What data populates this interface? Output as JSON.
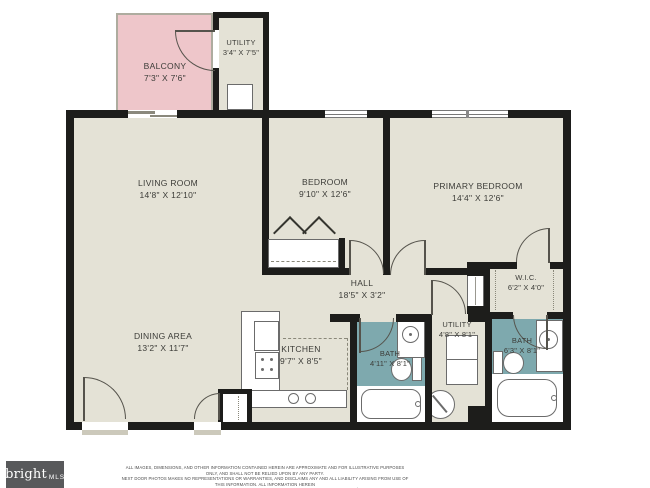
{
  "rooms": {
    "balcony": {
      "name": "BALCONY",
      "dims": "7'3\" X 7'6\""
    },
    "utility_top": {
      "name": "UTILITY",
      "dims": "3'4\" X 7'5\""
    },
    "living_room": {
      "name": "LIVING ROOM",
      "dims": "14'8\" X 12'10\""
    },
    "bedroom": {
      "name": "BEDROOM",
      "dims": "9'10\" X 12'6\""
    },
    "primary_bedroom": {
      "name": "PRIMARY BEDROOM",
      "dims": "14'4\" X 12'6\""
    },
    "hall": {
      "name": "HALL",
      "dims": "18'5\" X 3'2\""
    },
    "wic": {
      "name": "W.I.C.",
      "dims": "6'2\" X 4'0\""
    },
    "dining_area": {
      "name": "DINING AREA",
      "dims": "13'2\" X 11'7\""
    },
    "kitchen": {
      "name": "KITCHEN",
      "dims": "9'7\" X 8'5\""
    },
    "bath_hall": {
      "name": "BATH",
      "dims": "4'11\" X 8'1\""
    },
    "utility_lower": {
      "name": "UTILITY",
      "dims": "4'8\" X 8'1\""
    },
    "bath_primary": {
      "name": "BATH",
      "dims": "6'3\" X 8'1\""
    }
  },
  "branding": {
    "logo_primary": "bright",
    "logo_secondary": "MLS",
    "logo_bg": "#58595b",
    "logo_accent": "#b5683f"
  },
  "disclaimer": {
    "line1": "ALL IMAGES, DIMENSIONS, AND OTHER INFORMATION CONTAINED HEREIN ARE APPROXIMATE AND FOR ILLUSTRATIVE PURPOSES ONLY, AND SHALL NOT BE RELIED UPON BY ANY PARTY.",
    "line2": "NEXT DOOR PHOTOS MAKES NO REPRESENTATIONS OR WARRANTIES, AND DISCLAIMS ANY AND ALL LIABILITY ARISING FROM USE OF THIS INFORMATION. ALL INFORMATION HEREIN",
    "line3": "SHALL BE SUBJECT TO THE TERMS AND CONDITIONS FOUND AT NEXTDOORPHOTOS.COM/TC."
  },
  "colors": {
    "wall": "#1d1d1b",
    "floor": "#e4e2d6",
    "balcony_floor": "#eec6ca",
    "bath_floor": "#7ea9ae"
  }
}
